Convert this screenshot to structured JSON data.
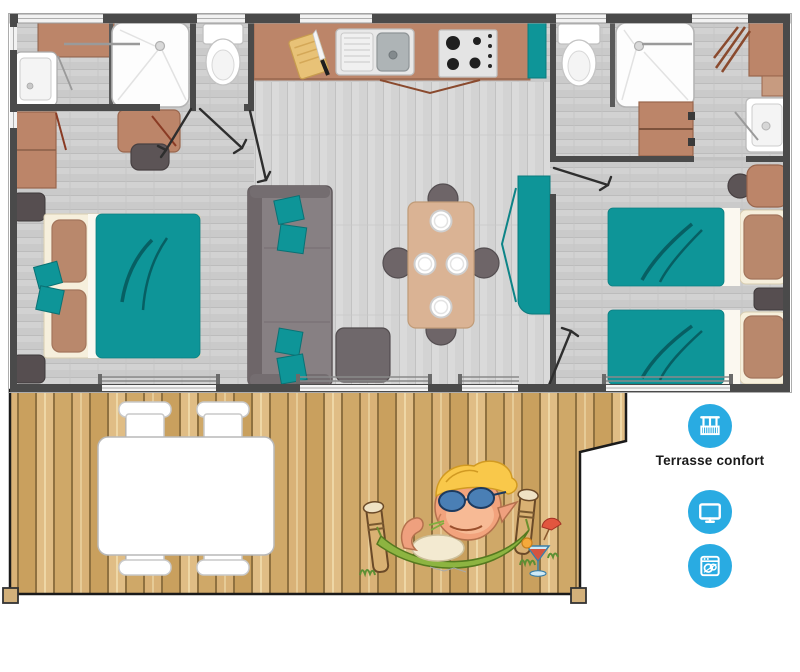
{
  "legend": {
    "items": [
      {
        "label": "Terrasse confort",
        "icon": "balcony-icon"
      },
      {
        "label": "",
        "icon": "tv-icon"
      },
      {
        "label": "",
        "icon": "dishwasher-icon"
      }
    ]
  },
  "colors": {
    "icon_blue": "#29abe2",
    "teal": "#0e9598",
    "teal_dark": "#0a7376",
    "wall": "#4a4a4a",
    "floor_gray": "#cbcbcb",
    "furniture_brown": "#bc8569",
    "pillow_brown": "#b9886c",
    "cream": "#f6efdc",
    "dark_gray_furniture": "#5c5456",
    "sofa_gray": "#878083",
    "deck_wood": "#d5ae6f",
    "label_text": "#1a1a1a",
    "white": "#ffffff"
  },
  "plan": {
    "rooms": [
      "bathroom",
      "wc",
      "kitchen",
      "double-bedroom",
      "living-dining",
      "bathroom-2",
      "twin-bedroom",
      "terrace"
    ],
    "furniture": [
      "washbasin",
      "shower",
      "toilet",
      "kitchen-counter",
      "sink",
      "stove",
      "cutting-board",
      "wardrobe",
      "desk",
      "double-bed",
      "nightstands",
      "sofa",
      "ottoman",
      "dining-table",
      "dining-chairs",
      "plates",
      "teal-cabinet",
      "twin-beds",
      "vanity",
      "drawer-cabinet",
      "terrace-table",
      "terrace-chairs",
      "hammock-mascot"
    ]
  }
}
